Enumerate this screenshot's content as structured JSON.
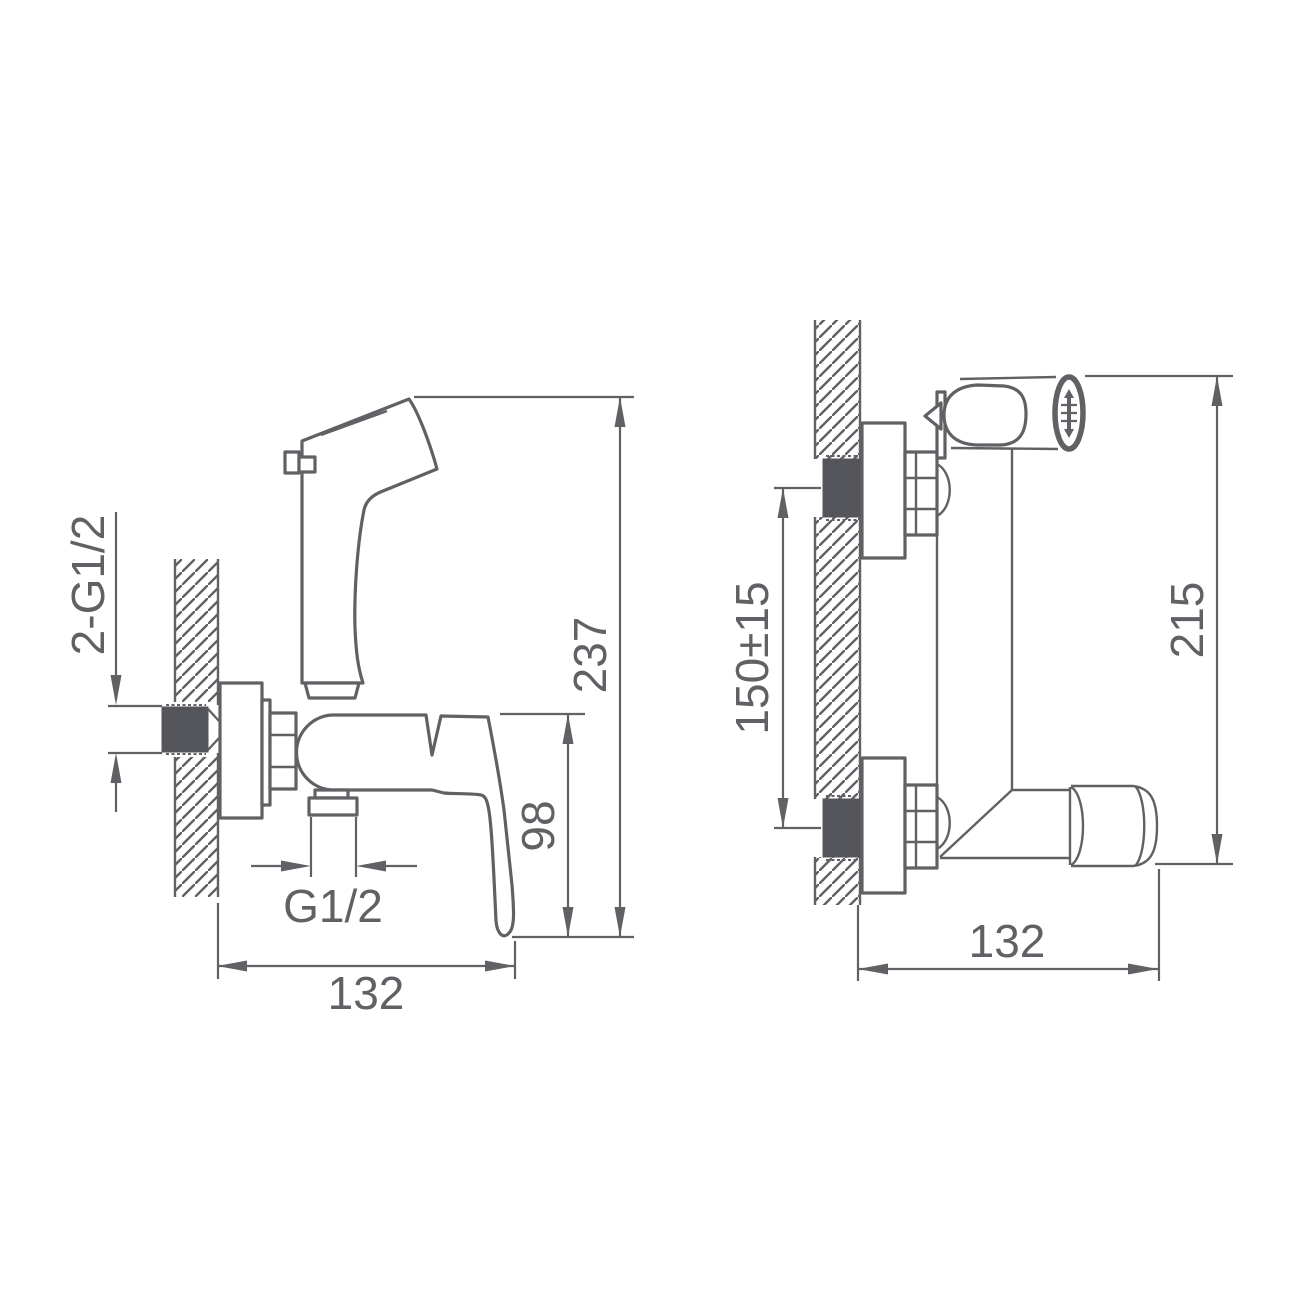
{
  "drawing": {
    "type": "technical-drawing",
    "colors": {
      "line": "#606164",
      "dark_fill": "#55565b",
      "background": "#ffffff",
      "text": "#606164"
    },
    "side_view": {
      "dims": {
        "wall_thread": "2-G1/2",
        "overall_height": "237",
        "body_height": "98",
        "outlet_thread": "G1/2",
        "depth": "132"
      }
    },
    "front_view": {
      "dims": {
        "mount_spacing": "150±15",
        "overall_height": "215",
        "width": "132"
      }
    }
  }
}
